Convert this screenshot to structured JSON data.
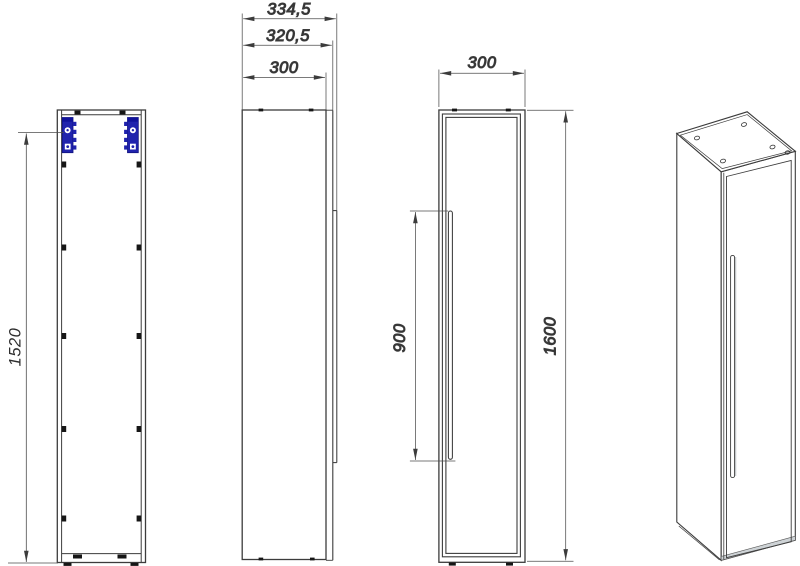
{
  "drawing": {
    "type": "technical-drawing",
    "subject": "Tall wall-hung cabinet (one door, recessed handle) — orthographic views and isometric",
    "units": "mm",
    "views": {
      "front_carcass": {
        "label": "front view, door removed (carcass with wall brackets)",
        "dims": {
          "mounting_height": "1520"
        }
      },
      "side": {
        "label": "side view",
        "dims": {
          "overall_depth": "334,5",
          "depth_with_door": "320,5",
          "carcass_depth": "300"
        }
      },
      "front_door": {
        "label": "front view with door",
        "dims": {
          "width": "300",
          "handle_length": "900",
          "overall_height": "1600"
        }
      },
      "isometric": {
        "label": "isometric view"
      }
    },
    "colors": {
      "background": "#ffffff",
      "line": "#3c3c3c",
      "dimension": "#4e4e4e",
      "text": "#2d2d2d",
      "bracket_blue": "#2023ad",
      "shade_gray": "#ced3d6"
    }
  }
}
